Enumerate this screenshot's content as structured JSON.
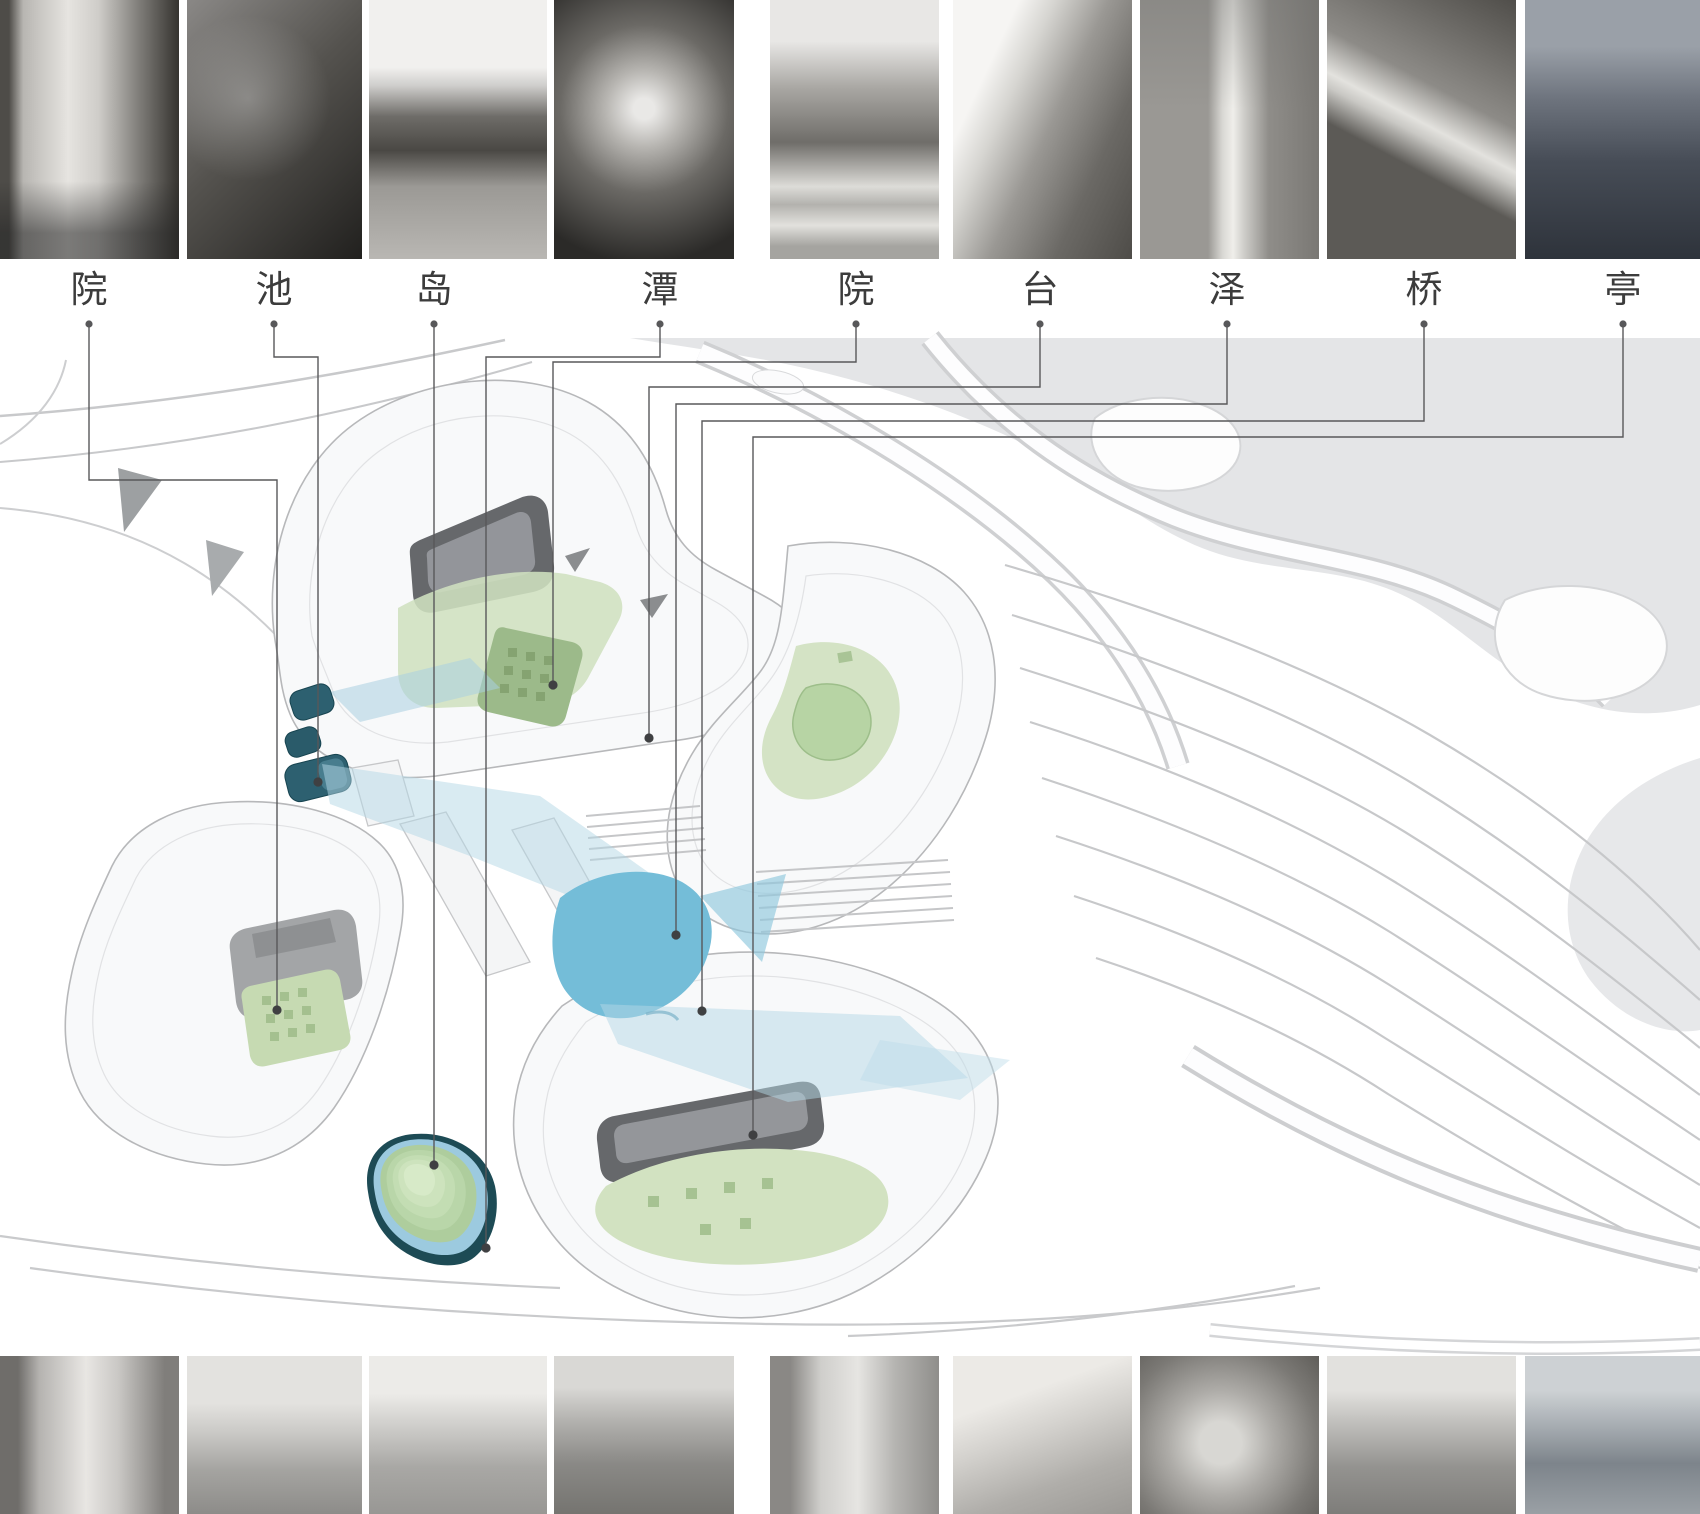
{
  "legend": {
    "items": [
      {
        "char": "院",
        "photo_subject": "glass-walled courtyard with birch trees"
      },
      {
        "char": "池",
        "photo_subject": "zigzag dark pond on patterned paving, aerial view"
      },
      {
        "char": "岛",
        "photo_subject": "planted tree islands with boats on a lake"
      },
      {
        "char": "潭",
        "photo_subject": "indoor pool among tall trees with curved terraces"
      },
      {
        "char": "院",
        "photo_subject": "tree-lined paved courtyard walk"
      },
      {
        "char": "台",
        "photo_subject": "grassed terrace steps beside white wall"
      },
      {
        "char": "泽",
        "photo_subject": "narrow stream winding through woods"
      },
      {
        "char": "桥",
        "photo_subject": "timber footbridge over garden pond with stone lantern"
      },
      {
        "char": "亭",
        "photo_subject": "waterside pavilion at dusk"
      }
    ]
  },
  "bottom_photos": [
    {
      "subject": "narrow brick alley between courtyard houses"
    },
    {
      "subject": "garden pond with pavilion and willow bank"
    },
    {
      "subject": "taihu rockery in front of white hall"
    },
    {
      "subject": "rock waterfall pond with garden pavilion"
    },
    {
      "subject": "veranda courtyard with potted plants"
    },
    {
      "subject": "terraced hillside steps with tiled roofs"
    },
    {
      "subject": "lotus leaves and blossoms close-up"
    },
    {
      "subject": "covered corridor bridge over stream"
    },
    {
      "subject": "double-eave pavilion above lotus lake"
    }
  ],
  "colors": {
    "courtyard_green": "#cfe0bf",
    "garden_green_dark": "#9cba8a",
    "pond_blue": "#74bdd8",
    "marsh_blue": "#b3d8e6",
    "pool_teal": "#2d6070",
    "island_ring_teal": "#1d4b55",
    "lake_gray": "#e4e5e7",
    "contour_gray": "#c7c8ca",
    "leader_line": "#58585a",
    "label_text": "#3c3c3c"
  }
}
